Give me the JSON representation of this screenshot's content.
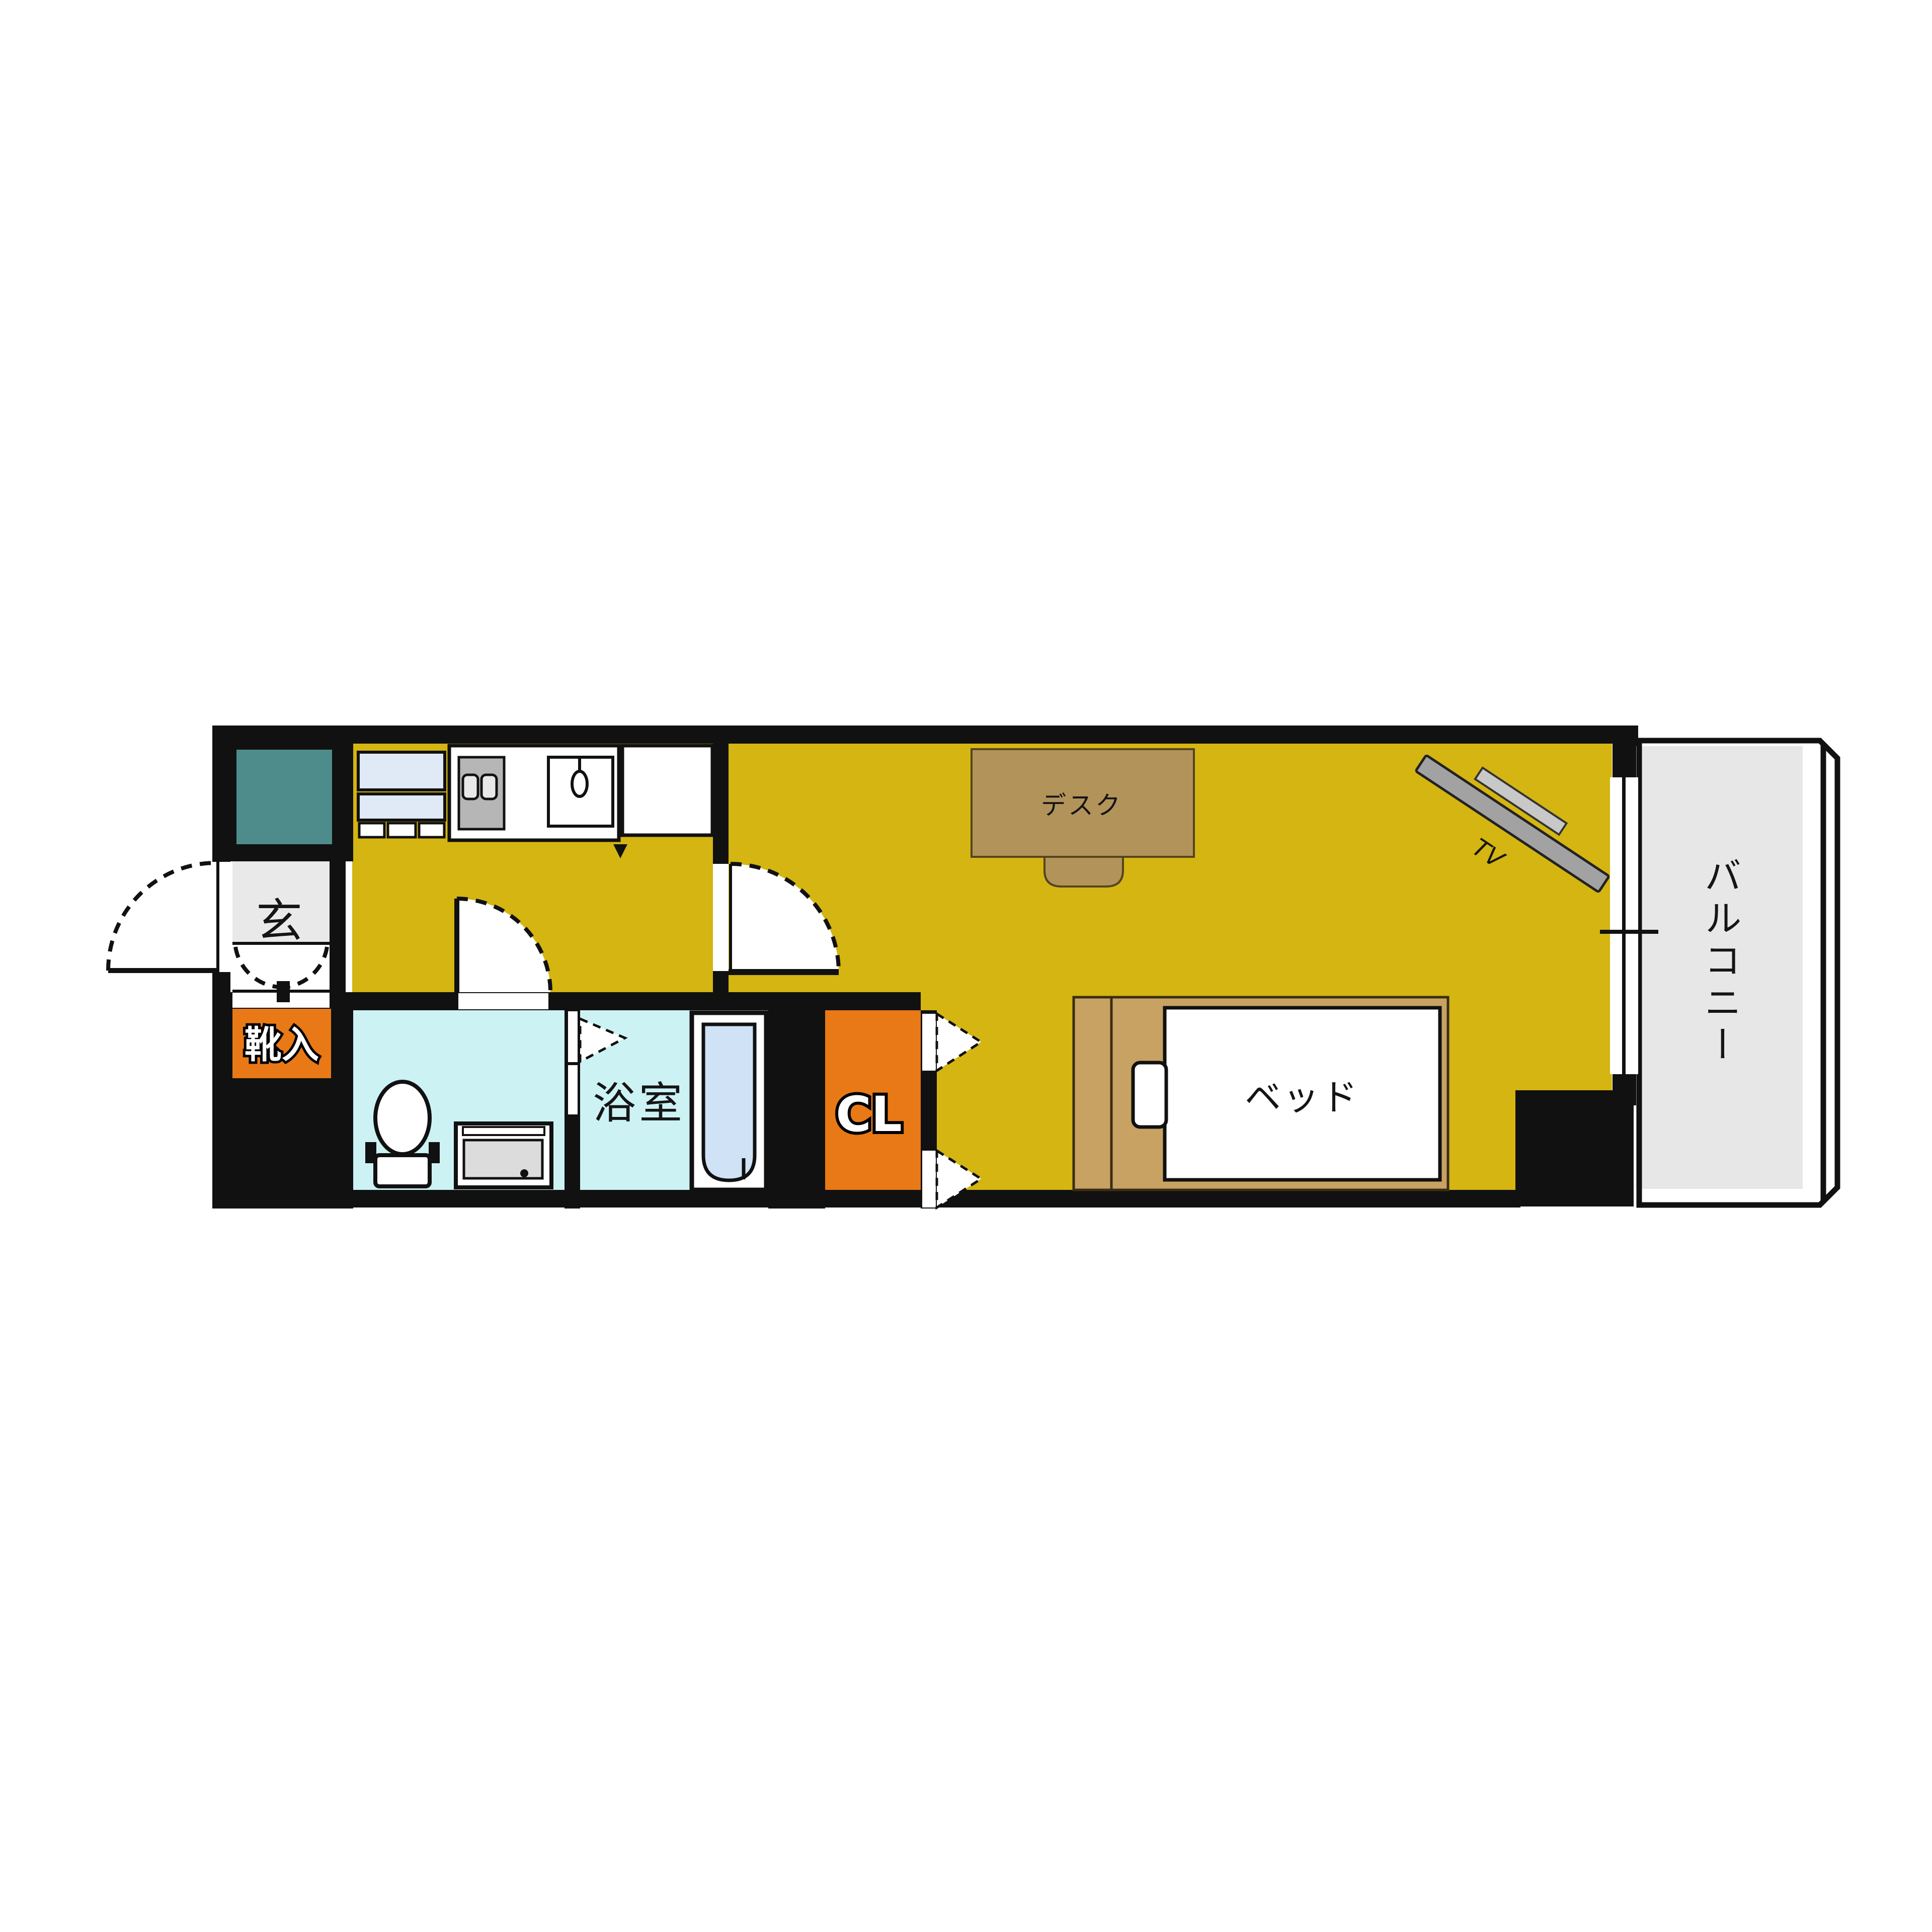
{
  "plan": {
    "type": "apartment-floor-plan-1K",
    "rooms": {
      "entrance": {
        "label": "玄"
      },
      "shoe_cabinet": {
        "label": "靴入"
      },
      "bathroom": {
        "label": "浴室"
      },
      "closet": {
        "label": "CL"
      },
      "balcony": {
        "label": "バルコニー"
      }
    },
    "furniture": {
      "desk": {
        "label": "デスク"
      },
      "bed": {
        "label": "ベッド"
      },
      "tv": {
        "label": "TV"
      }
    },
    "fixtures": [
      "refrigerator-icon",
      "stove-icon",
      "sink-icon",
      "toilet-icon",
      "washing-machine-icon",
      "bathtub-icon"
    ],
    "colors": {
      "wall": "#111111",
      "living_floor": "#d4b512",
      "kitchen_floor": "#d4b512",
      "wet_floor": "#ccf2f4",
      "entrance_floor": "#e9e9e9",
      "balcony_floor": "#e7e7e7",
      "closet_accent": "#e87916",
      "shoe_accent": "#e87916",
      "utility_teal": "#4e8b8b",
      "bathtub": "#cfe2f6",
      "appliance_blue": "#dfeaf6",
      "stove_gray": "#b6b6b6",
      "washer_gray": "#dcdcdc",
      "furniture_desk": "#b29359",
      "furniture_bed": "#c7a263",
      "tv_gray": "#a2a2a2"
    }
  }
}
